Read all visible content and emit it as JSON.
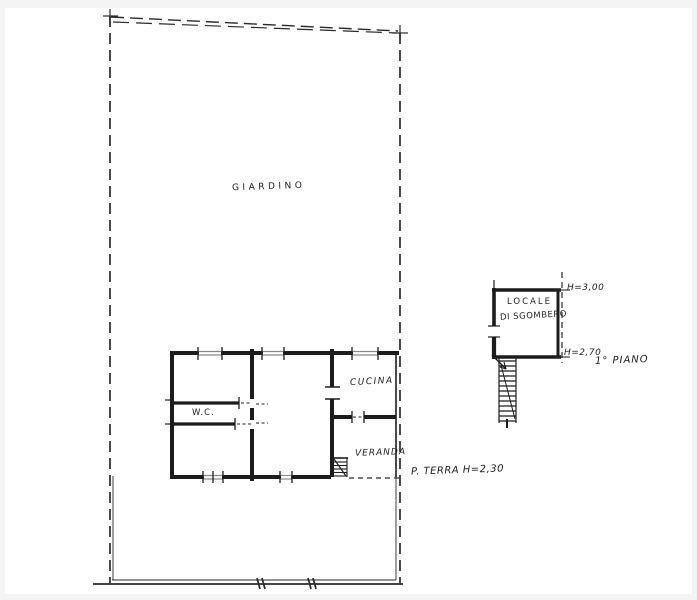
{
  "drawing": {
    "type": "hand-drawn floor plan sketch",
    "ink_color": "#1f1f1f",
    "paper_color": "#ffffff",
    "frame_color": "#f4f4f4",
    "window_color": "#8a8a8a"
  },
  "labels": {
    "garden": "GIARDINO",
    "wc": "W.C.",
    "kitchen": "CUCINA",
    "veranda": "VERANDA",
    "ground_floor_note": "P. TERRA H=2,30",
    "storage_room_line1": "LOCALE",
    "storage_room_line2": "DI SGOMBERO",
    "storage_height_top": "H=3,00",
    "storage_height_bottom": "H=2,70",
    "first_floor_note": "1° PIANO"
  }
}
